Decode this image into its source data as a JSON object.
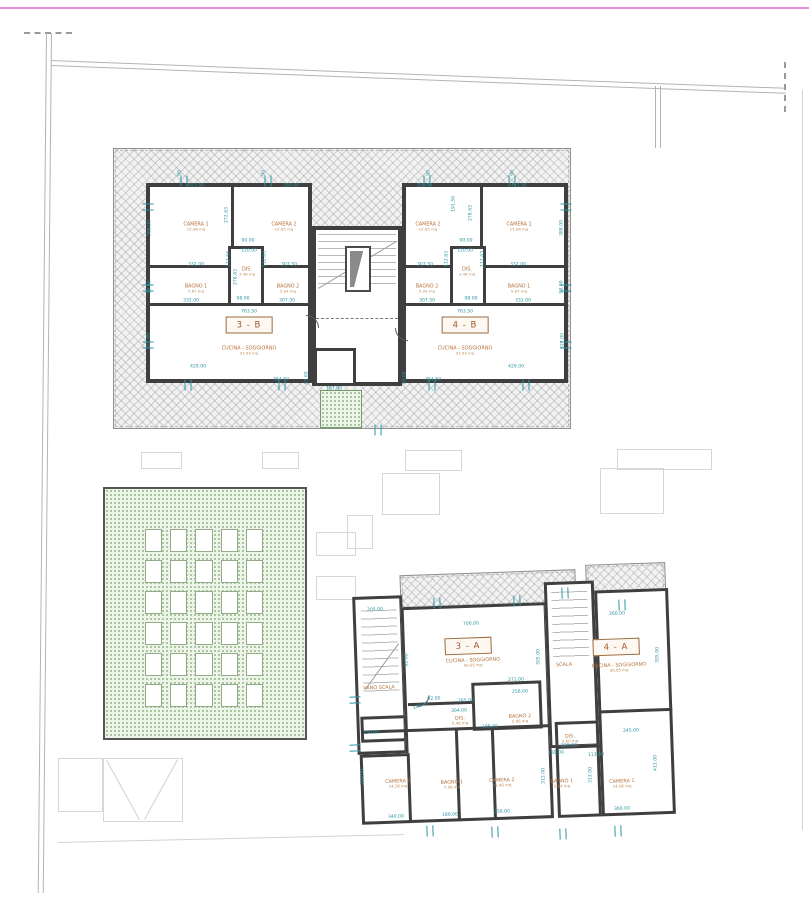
{
  "meta": {
    "drawing_type": "architectural floor plan",
    "language": "Italian"
  },
  "colors": {
    "wall": "#3f3f3f",
    "dimension_text": "#2d95a5",
    "room_label": "#b5713b",
    "unit_label": "#a0572a",
    "boundary_pink": "#e78fd8",
    "garden_green": "#6f9a66",
    "hatch_gray": "#c5c5c5"
  },
  "units": [
    {
      "text": "3 - B",
      "x": 249,
      "y": 325
    },
    {
      "text": "4 - B",
      "x": 465,
      "y": 325
    },
    {
      "text": "3 - A",
      "x": 468,
      "y": 646,
      "rot": -2
    },
    {
      "text": "4 - A",
      "x": 616,
      "y": 647,
      "rot": -2
    }
  ],
  "rooms": [
    {
      "name": "CAMERA 1",
      "area": "15.08 mq",
      "x": 196,
      "y": 227
    },
    {
      "name": "CAMERA 2",
      "area": "12.85 mq",
      "x": 284,
      "y": 227
    },
    {
      "name": "BAGNO 1",
      "area": "5.67 mq",
      "x": 196,
      "y": 289
    },
    {
      "name": "BAGNO 2",
      "area": "5.04 mq",
      "x": 288,
      "y": 289
    },
    {
      "name": "DIS.",
      "area": "3.48 mq",
      "x": 247,
      "y": 272
    },
    {
      "name": "CUCINA - SOGGIORNO",
      "area": "37.94 mq",
      "x": 249,
      "y": 351
    },
    {
      "name": "CAMERA 2",
      "area": "12.85 mq",
      "x": 428,
      "y": 227
    },
    {
      "name": "CAMERA 1",
      "area": "15.08 mq",
      "x": 519,
      "y": 227
    },
    {
      "name": "BAGNO 2",
      "area": "5.04 mq",
      "x": 427,
      "y": 289
    },
    {
      "name": "BAGNO 1",
      "area": "5.67 mq",
      "x": 519,
      "y": 289
    },
    {
      "name": "DIS.",
      "area": "3.48 mq",
      "x": 467,
      "y": 272
    },
    {
      "name": "CUCINA - SOGGIORNO",
      "area": "37.94 mq",
      "x": 465,
      "y": 351
    },
    {
      "name": "VANO SCALA",
      "area": "",
      "x": 379,
      "y": 688,
      "rot": -2
    },
    {
      "name": "SCALA",
      "area": "",
      "x": 564,
      "y": 665,
      "rot": -2
    },
    {
      "name": "CUCINA - SOGGIORNO",
      "area": "40.05 mq",
      "x": 473,
      "y": 663,
      "rot": -2
    },
    {
      "name": "CUCINA - SOGGIORNO",
      "area": "30.05 mq",
      "x": 619,
      "y": 668,
      "rot": -2
    },
    {
      "name": "BAGNO 2",
      "area": "5.96 mq",
      "x": 520,
      "y": 719,
      "rot": -2
    },
    {
      "name": "DIS.",
      "area": "5.48 mq",
      "x": 460,
      "y": 721,
      "rot": -2
    },
    {
      "name": "DIS.",
      "area": "2.60 mq",
      "x": 570,
      "y": 739,
      "rot": -2
    },
    {
      "name": "CAMERA 1",
      "area": "14.26 mq",
      "x": 398,
      "y": 784,
      "rot": -2
    },
    {
      "name": "BAGNO 1",
      "area": "7.06 mq",
      "x": 452,
      "y": 785,
      "rot": -2
    },
    {
      "name": "CAMERA 2",
      "area": "11.46 mq",
      "x": 502,
      "y": 783,
      "rot": -2
    },
    {
      "name": "BAGNO 1",
      "area": "5.64 mq",
      "x": 562,
      "y": 784,
      "rot": -2
    },
    {
      "name": "CAMERA 1",
      "area": "14.06 mq",
      "x": 622,
      "y": 784,
      "rot": -2
    }
  ],
  "dimensions": [
    {
      "text": "421.50",
      "x": 196,
      "y": 187
    },
    {
      "text": "350.00",
      "x": 291,
      "y": 187
    },
    {
      "text": "350.00",
      "x": 424,
      "y": 187
    },
    {
      "text": "421.50",
      "x": 519,
      "y": 187
    },
    {
      "text": "388.00",
      "x": 151,
      "y": 228,
      "rot": -90
    },
    {
      "text": "272.63",
      "x": 228,
      "y": 215,
      "rot": -90
    },
    {
      "text": "278.63",
      "x": 237,
      "y": 277,
      "rot": -90
    },
    {
      "text": "112.63",
      "x": 230,
      "y": 259,
      "rot": -90
    },
    {
      "text": "112.63",
      "x": 266,
      "y": 259,
      "rot": -90
    },
    {
      "text": "98.00",
      "x": 151,
      "y": 287,
      "rot": -90
    },
    {
      "text": "327.00",
      "x": 150,
      "y": 341,
      "rot": -90
    },
    {
      "text": "65.00",
      "x": 308,
      "y": 378,
      "rot": -90
    },
    {
      "text": "90.00",
      "x": 248,
      "y": 242
    },
    {
      "text": "120.00",
      "x": 249,
      "y": 252
    },
    {
      "text": "332.00",
      "x": 196,
      "y": 266
    },
    {
      "text": "307.50",
      "x": 289,
      "y": 266
    },
    {
      "text": "332.00",
      "x": 191,
      "y": 302
    },
    {
      "text": "307.50",
      "x": 287,
      "y": 302
    },
    {
      "text": "98.00",
      "x": 243,
      "y": 300
    },
    {
      "text": "763.50",
      "x": 249,
      "y": 313
    },
    {
      "text": "429.00",
      "x": 198,
      "y": 368
    },
    {
      "text": "354.50",
      "x": 281,
      "y": 381
    },
    {
      "text": "388.00",
      "x": 563,
      "y": 228,
      "rot": -90
    },
    {
      "text": "191.50",
      "x": 455,
      "y": 204,
      "rot": -90
    },
    {
      "text": "278.63",
      "x": 472,
      "y": 213,
      "rot": -90
    },
    {
      "text": "112.63",
      "x": 448,
      "y": 259,
      "rot": -90
    },
    {
      "text": "112.63",
      "x": 484,
      "y": 259,
      "rot": -90
    },
    {
      "text": "98.00",
      "x": 563,
      "y": 287,
      "rot": -90
    },
    {
      "text": "327.00",
      "x": 564,
      "y": 341,
      "rot": -90
    },
    {
      "text": "65.00",
      "x": 406,
      "y": 378,
      "rot": -90
    },
    {
      "text": "90.00",
      "x": 466,
      "y": 242
    },
    {
      "text": "120.00",
      "x": 465,
      "y": 252
    },
    {
      "text": "307.50",
      "x": 425,
      "y": 266
    },
    {
      "text": "332.00",
      "x": 518,
      "y": 266
    },
    {
      "text": "307.50",
      "x": 427,
      "y": 302
    },
    {
      "text": "332.00",
      "x": 523,
      "y": 302
    },
    {
      "text": "98.00",
      "x": 471,
      "y": 300
    },
    {
      "text": "763.50",
      "x": 465,
      "y": 313
    },
    {
      "text": "429.00",
      "x": 516,
      "y": 368
    },
    {
      "text": "354.50",
      "x": 433,
      "y": 381
    },
    {
      "text": "187.00",
      "x": 334,
      "y": 390
    },
    {
      "text": "90",
      "x": 181,
      "y": 173,
      "rot": -90
    },
    {
      "text": "90",
      "x": 265,
      "y": 173,
      "rot": -90
    },
    {
      "text": "90",
      "x": 430,
      "y": 173,
      "rot": -90
    },
    {
      "text": "90",
      "x": 514,
      "y": 173,
      "rot": -90
    },
    {
      "text": "205.00",
      "x": 375,
      "y": 611,
      "rot": -2
    },
    {
      "text": "150.00",
      "x": 371,
      "y": 734,
      "rot": -2
    },
    {
      "text": "700.00",
      "x": 471,
      "y": 625,
      "rot": -2
    },
    {
      "text": "260.00",
      "x": 617,
      "y": 615,
      "rot": -2
    },
    {
      "text": "92.00",
      "x": 408,
      "y": 660,
      "rot": -90
    },
    {
      "text": "305.00",
      "x": 540,
      "y": 657,
      "rot": -90
    },
    {
      "text": "305.00",
      "x": 659,
      "y": 655,
      "rot": -90
    },
    {
      "text": "271.00",
      "x": 516,
      "y": 681,
      "rot": -2
    },
    {
      "text": "256.00",
      "x": 520,
      "y": 693,
      "rot": -2
    },
    {
      "text": "92.00",
      "x": 434,
      "y": 700,
      "rot": -2
    },
    {
      "text": "108.00",
      "x": 421,
      "y": 707,
      "rot": -20
    },
    {
      "text": "265.00",
      "x": 466,
      "y": 702,
      "rot": -2
    },
    {
      "text": "304.00",
      "x": 459,
      "y": 712,
      "rot": -2
    },
    {
      "text": "186.00",
      "x": 490,
      "y": 728,
      "rot": -2
    },
    {
      "text": "220.00",
      "x": 569,
      "y": 747,
      "rot": -2
    },
    {
      "text": "180.00",
      "x": 556,
      "y": 754,
      "rot": -2
    },
    {
      "text": "113.00",
      "x": 596,
      "y": 756,
      "rot": -2
    },
    {
      "text": "245.00",
      "x": 631,
      "y": 732,
      "rot": -2
    },
    {
      "text": "318.00",
      "x": 364,
      "y": 777,
      "rot": -90
    },
    {
      "text": "313.00",
      "x": 545,
      "y": 776,
      "rot": -90
    },
    {
      "text": "313.00",
      "x": 592,
      "y": 775,
      "rot": -90
    },
    {
      "text": "413.00",
      "x": 657,
      "y": 763,
      "rot": -90
    },
    {
      "text": "340.00",
      "x": 396,
      "y": 818,
      "rot": -2
    },
    {
      "text": "180.00",
      "x": 450,
      "y": 816,
      "rot": -2
    },
    {
      "text": "256.00",
      "x": 502,
      "y": 813,
      "rot": -2
    },
    {
      "text": "360.00",
      "x": 622,
      "y": 810,
      "rot": -2
    }
  ],
  "windows": [
    {
      "x": 184,
      "y": 181
    },
    {
      "x": 268,
      "y": 181
    },
    {
      "x": 427,
      "y": 181
    },
    {
      "x": 512,
      "y": 181
    },
    {
      "x": 148,
      "y": 207,
      "rot": 90
    },
    {
      "x": 148,
      "y": 288,
      "rot": 90
    },
    {
      "x": 148,
      "y": 345,
      "rot": 90
    },
    {
      "x": 566,
      "y": 207,
      "rot": 90
    },
    {
      "x": 566,
      "y": 288,
      "rot": 90
    },
    {
      "x": 566,
      "y": 345,
      "rot": 90
    },
    {
      "x": 188,
      "y": 385
    },
    {
      "x": 282,
      "y": 385
    },
    {
      "x": 432,
      "y": 385
    },
    {
      "x": 526,
      "y": 385
    },
    {
      "x": 378,
      "y": 430
    },
    {
      "x": 437,
      "y": 603,
      "rot": -2
    },
    {
      "x": 517,
      "y": 601,
      "rot": -2
    },
    {
      "x": 565,
      "y": 593,
      "rot": -2
    },
    {
      "x": 622,
      "y": 605,
      "rot": -2
    },
    {
      "x": 430,
      "y": 831,
      "rot": -2
    },
    {
      "x": 495,
      "y": 832,
      "rot": -2
    },
    {
      "x": 563,
      "y": 834,
      "rot": -2
    },
    {
      "x": 618,
      "y": 831,
      "rot": -2
    },
    {
      "x": 355,
      "y": 700,
      "rot": 88
    },
    {
      "x": 355,
      "y": 748,
      "rot": 88
    }
  ],
  "garden": {
    "rows": 6,
    "cols": 5
  }
}
